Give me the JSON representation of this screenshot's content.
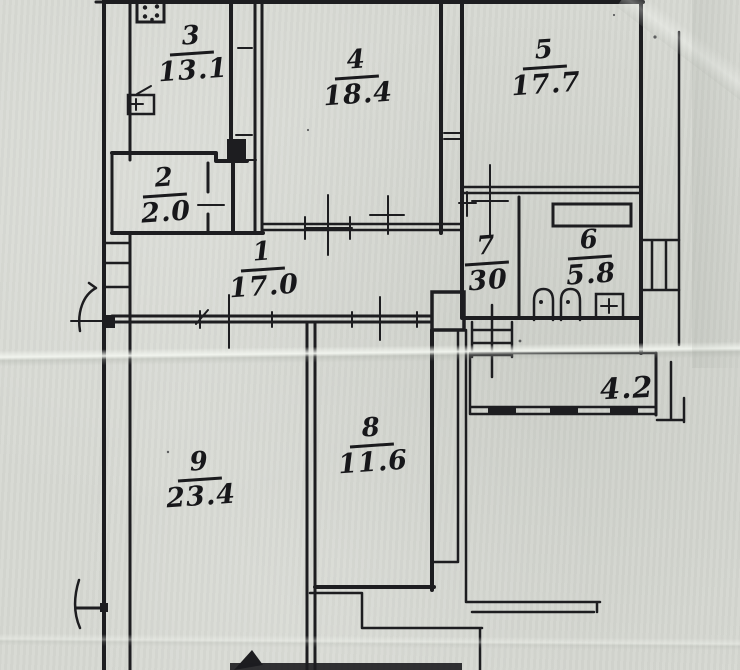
{
  "colors": {
    "paper": "#d6d8d2",
    "ink": "#1d1d20"
  },
  "rooms": [
    {
      "id": "room-1",
      "number": "1",
      "area": "17.0"
    },
    {
      "id": "room-2",
      "number": "2",
      "area": "2.0"
    },
    {
      "id": "room-3",
      "number": "3",
      "area": "13.1"
    },
    {
      "id": "room-4",
      "number": "4",
      "area": "18.4"
    },
    {
      "id": "room-5",
      "number": "5",
      "area": "17.7"
    },
    {
      "id": "room-6",
      "number": "6",
      "area": "5.8"
    },
    {
      "id": "room-7",
      "number": "7",
      "area": "30"
    },
    {
      "id": "room-8",
      "number": "8",
      "area": "11.6"
    },
    {
      "id": "room-9",
      "number": "9",
      "area": "23.4"
    }
  ],
  "balcony": {
    "label": "4.2"
  },
  "icons": [
    "stove-icon",
    "sink-icon",
    "shelf-icon",
    "toilet-icon",
    "toilet-icon",
    "washbasin-icon",
    "stairs-icon",
    "ladder-icon",
    "balcony-railing",
    "entrance-arc-mark",
    "survey-cross-marks",
    "arrow-mark"
  ]
}
